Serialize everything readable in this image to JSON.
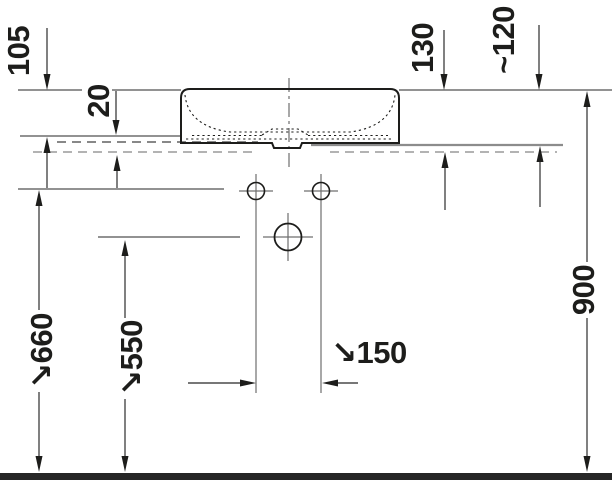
{
  "drawing": {
    "kind": "washbasin installation dimension drawing, side elevation",
    "colors": {
      "ink": "#1d1d1b",
      "reference_line": "#6f6f6f",
      "light_line": "#9a9a9a",
      "floor_bar": "#262626",
      "background": "#ffffff"
    },
    "dims": {
      "d105": {
        "label": "105"
      },
      "d20": {
        "label": "20"
      },
      "d130": {
        "label": "130"
      },
      "d120": {
        "label": "~120"
      },
      "d900": {
        "label": "900"
      },
      "d660": {
        "label": "660",
        "arrow": "↘"
      },
      "d550": {
        "label": "550",
        "arrow": "↘"
      },
      "d150": {
        "label": "150",
        "arrow": "↘"
      }
    }
  }
}
